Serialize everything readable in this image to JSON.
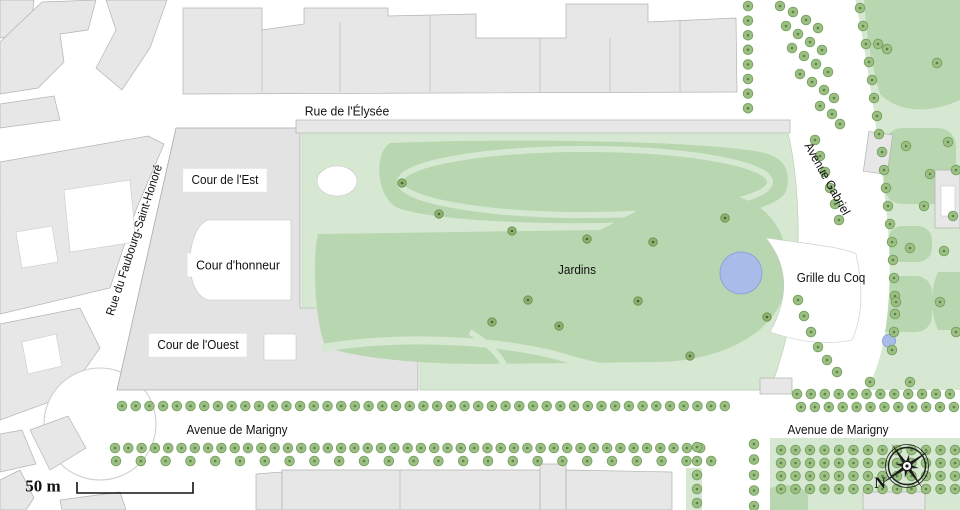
{
  "map": {
    "street_labels": {
      "rue_de_l_elysee": "Rue de l'Élysée",
      "rue_du_faubourg_saint_honore": "Rue du Faubourg-Saint-Honoré",
      "avenue_gabriel": "Avenue Gabriel",
      "avenue_de_marigny_west": "Avenue de Marigny",
      "avenue_de_marigny_east": "Avenue de Marigny"
    },
    "place_labels": {
      "cour_de_l_est": "Cour de l'Est",
      "cour_d_honneur": "Cour d'honneur",
      "cour_de_l_ouest": "Cour de l'Ouest",
      "jardins": "Jardins",
      "grille_du_coq": "Grille du Coq"
    },
    "scale": {
      "label": "50 m"
    },
    "compass": {
      "north_label": "N"
    },
    "icons": {
      "tree": "green-circle-glyph",
      "pond": "blue-circle",
      "compass_rose": "eight-point-star",
      "scale_bar": "bracket-line"
    },
    "colors": {
      "bldg": "#e7e7e7",
      "bldg_stroke": "#b3b3b3",
      "palace": "#e3e3e3",
      "palace_stroke": "#a9a9a9",
      "green_light": "#d6e8d1",
      "green_dark": "#b8d7b0",
      "garden_stroke": "#bad0b5",
      "tree_fill": "#9cc084",
      "tree_stroke": "#74a05e",
      "tree_dot": "#5e8148",
      "tree_dark_fill": "#8fb270",
      "tree_dark_stroke": "#698f4f",
      "tree_dark_dot": "#46642f",
      "pond": "#a9bce9",
      "pond_stroke": "#8da4da",
      "road": "#ffffff",
      "compass": "#1e1e1e",
      "text": "#121212"
    }
  }
}
